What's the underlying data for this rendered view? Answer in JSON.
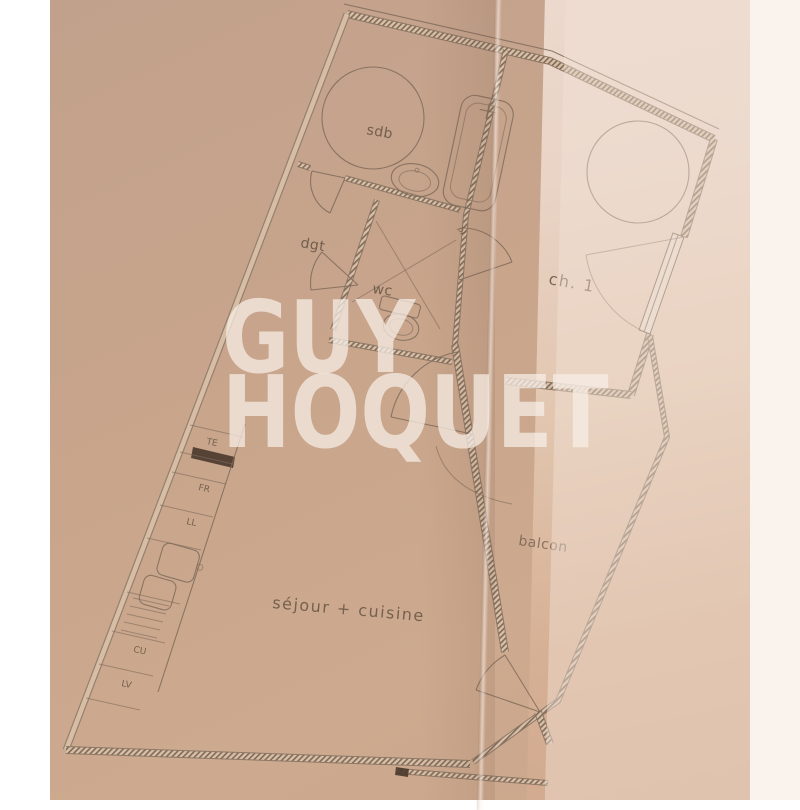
{
  "watermark": {
    "line1": "GUY",
    "line2": "HOQUET"
  },
  "rooms": {
    "bathroom": "sdb",
    "hall": "dgt",
    "wc": "wc",
    "closet": "pl",
    "bedroom": "ch. 1",
    "living_kitchen": "séjour + cuisine",
    "balcony": "balcon"
  },
  "kitchen": {
    "te": "TE",
    "fr": "FR",
    "ll": "LL",
    "cu": "CU",
    "lv": "LV"
  },
  "colors": {
    "background": "#ffffff",
    "paper": "#c8a58b",
    "fold_page": "#e9d4c6",
    "plan_line": "#7f6b5b",
    "wall_edge": "#8d7866",
    "hatch": "#7f6a5a",
    "label": "#675544",
    "dark_unit": "#4a382c",
    "watermark": "rgba(247,238,230,0.74)"
  }
}
